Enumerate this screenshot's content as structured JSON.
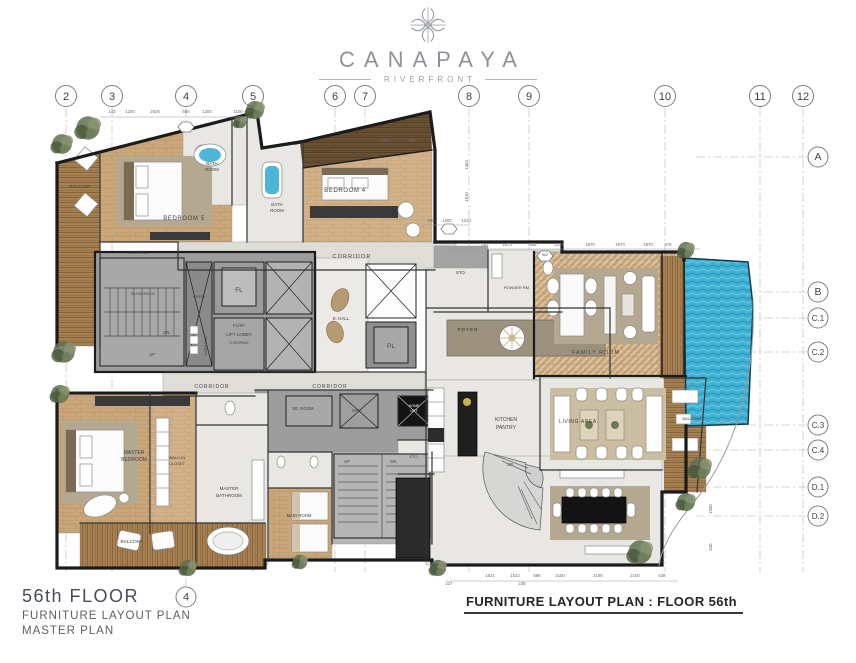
{
  "header": {
    "brand": "CANAPAYA",
    "sub": "RIVERFRONT",
    "logo_icon": "compass-rosette-icon"
  },
  "titles": {
    "floor": "56th FLOOR",
    "line1": "FURNITURE LAYOUT PLAN",
    "line2": "MASTER PLAN",
    "sheet_title": "FURNITURE LAYOUT PLAN : FLOOR 56th"
  },
  "grid": {
    "cols": [
      {
        "label": "2",
        "x": 66
      },
      {
        "label": "3",
        "x": 112
      },
      {
        "label": "4",
        "x": 186
      },
      {
        "label": "5",
        "x": 253
      },
      {
        "label": "6",
        "x": 335
      },
      {
        "label": "7",
        "x": 365
      },
      {
        "label": "8",
        "x": 469
      },
      {
        "label": "9",
        "x": 529
      },
      {
        "label": "10",
        "x": 665
      },
      {
        "label": "11",
        "x": 760
      },
      {
        "label": "12",
        "x": 803
      }
    ],
    "rows": [
      {
        "label": "A",
        "y": 157
      },
      {
        "label": "B",
        "y": 292
      },
      {
        "label": "C.1",
        "y": 318
      },
      {
        "label": "C.2",
        "y": 352
      },
      {
        "label": "C.3",
        "y": 425
      },
      {
        "label": "C.4",
        "y": 450
      },
      {
        "label": "D.1",
        "y": 487
      },
      {
        "label": "D.2",
        "y": 516
      }
    ],
    "extra": [
      {
        "label": "4",
        "x": 186,
        "y": 597
      }
    ]
  },
  "dimensions": [
    {
      "t": "143",
      "x": 112,
      "y": 113
    },
    {
      "t": "1200",
      "x": 130,
      "y": 113
    },
    {
      "t": "2625",
      "x": 155,
      "y": 113
    },
    {
      "t": "565",
      "x": 186,
      "y": 113
    },
    {
      "t": "1200",
      "x": 207,
      "y": 113
    },
    {
      "t": "2100",
      "x": 238,
      "y": 113
    },
    {
      "t": "470",
      "x": 256,
      "y": 113
    },
    {
      "t": "1083",
      "x": 386,
      "y": 142
    },
    {
      "t": "950",
      "x": 412,
      "y": 142
    },
    {
      "t": "590",
      "x": 431,
      "y": 222
    },
    {
      "t": "1300",
      "x": 447,
      "y": 222
    },
    {
      "t": "1310",
      "x": 466,
      "y": 222
    },
    {
      "t": "700",
      "x": 484,
      "y": 246
    },
    {
      "t": "1873",
      "x": 507,
      "y": 246
    },
    {
      "t": "555",
      "x": 533,
      "y": 246
    },
    {
      "t": "2235",
      "x": 559,
      "y": 246
    },
    {
      "t": "1870",
      "x": 590,
      "y": 246
    },
    {
      "t": "1870",
      "x": 620,
      "y": 246
    },
    {
      "t": "1870",
      "x": 648,
      "y": 246
    },
    {
      "t": "378",
      "x": 668,
      "y": 246
    },
    {
      "t": "1403",
      "x": 468,
      "y": 165,
      "r": -90
    },
    {
      "t": "1510",
      "x": 468,
      "y": 197,
      "r": -90
    },
    {
      "t": "1500",
      "x": 712,
      "y": 509,
      "r": -90
    },
    {
      "t": "640",
      "x": 712,
      "y": 547,
      "r": -90
    },
    {
      "t": "1521",
      "x": 490,
      "y": 577
    },
    {
      "t": "1522",
      "x": 515,
      "y": 577
    },
    {
      "t": "698",
      "x": 537,
      "y": 577
    },
    {
      "t": "2100",
      "x": 560,
      "y": 577
    },
    {
      "t": "2190",
      "x": 598,
      "y": 577
    },
    {
      "t": "2100",
      "x": 635,
      "y": 577
    },
    {
      "t": "638",
      "x": 662,
      "y": 577
    },
    {
      "t": "227",
      "x": 449,
      "y": 585
    },
    {
      "t": "238",
      "x": 522,
      "y": 585
    }
  ],
  "labels": [
    {
      "t": "BALCONY",
      "x": 80,
      "y": 188,
      "s": 4.6
    },
    {
      "t": "BEDROOM 5",
      "x": 184,
      "y": 220,
      "s": 6,
      "sp": 0.6
    },
    {
      "t": "BATH",
      "x": 212,
      "y": 165,
      "s": 4.4
    },
    {
      "t": "ROOM",
      "x": 212,
      "y": 171,
      "s": 4.4
    },
    {
      "t": "BATH",
      "x": 277,
      "y": 206,
      "s": 4.4
    },
    {
      "t": "ROOM",
      "x": 277,
      "y": 212,
      "s": 4.4
    },
    {
      "t": "BALCONY",
      "x": 322,
      "y": 153,
      "s": 4.4
    },
    {
      "t": "BEDROOM 4",
      "x": 345,
      "y": 192,
      "s": 6,
      "sp": 0.6
    },
    {
      "t": "CORRIDOR",
      "x": 352,
      "y": 258,
      "s": 5.4,
      "sp": 1.2
    },
    {
      "t": "CORRIDOR",
      "x": 212,
      "y": 388,
      "s": 5,
      "sp": 1
    },
    {
      "t": "CORRIDOR",
      "x": 330,
      "y": 388,
      "s": 5,
      "sp": 1
    },
    {
      "t": "TL/GR/F-/D-",
      "x": 137,
      "y": 254,
      "s": 3.8
    },
    {
      "t": "RL/SM/PA/CE",
      "x": 143,
      "y": 295,
      "s": 3.8
    },
    {
      "t": "DN.",
      "x": 167,
      "y": 334,
      "s": 4.4
    },
    {
      "t": "UP",
      "x": 152,
      "y": 356,
      "s": 4.4
    },
    {
      "t": "OPEN",
      "x": 199,
      "y": 298,
      "s": 4
    },
    {
      "t": "GARBAGE",
      "x": 207,
      "y": 346,
      "s": 4,
      "r": -90
    },
    {
      "t": "FL",
      "x": 239,
      "y": 292,
      "s": 6.5
    },
    {
      "t": "FL/SF",
      "x": 239,
      "y": 327,
      "s": 4.5
    },
    {
      "t": "LIFT LOBBY",
      "x": 239,
      "y": 336,
      "s": 4.5
    },
    {
      "t": "TL/GR/PA/CL",
      "x": 239,
      "y": 344,
      "s": 3.4
    },
    {
      "t": "E. HALL",
      "x": 341,
      "y": 320,
      "s": 4.4
    },
    {
      "t": "PL",
      "x": 391,
      "y": 348,
      "s": 6.5
    },
    {
      "t": "STO.",
      "x": 461,
      "y": 274,
      "s": 4.4
    },
    {
      "t": "POWDER RM.",
      "x": 517,
      "y": 289,
      "s": 4
    },
    {
      "t": "FOYER",
      "x": 468,
      "y": 331,
      "s": 4.6,
      "sp": 1,
      "c": "#2e2a24"
    },
    {
      "t": "FAMILY ROOM",
      "x": 596,
      "y": 354,
      "s": 5.4,
      "sp": 1
    },
    {
      "t": "KITCHEN",
      "x": 506,
      "y": 421,
      "s": 5
    },
    {
      "t": "PANTRY",
      "x": 506,
      "y": 429,
      "s": 5
    },
    {
      "t": "LIVING AREA",
      "x": 578,
      "y": 423,
      "s": 5,
      "sp": 0.6
    },
    {
      "t": "BALCONY",
      "x": 692,
      "y": 420,
      "s": 4
    },
    {
      "t": "UP",
      "x": 510,
      "y": 466,
      "s": 4.2
    },
    {
      "t": "MASTER",
      "x": 134,
      "y": 454,
      "s": 5
    },
    {
      "t": "BEDROOM",
      "x": 134,
      "y": 461,
      "s": 5
    },
    {
      "t": "WALK-IN",
      "x": 177,
      "y": 459,
      "s": 4
    },
    {
      "t": "CLOSET",
      "x": 177,
      "y": 465,
      "s": 4
    },
    {
      "t": "MASTER",
      "x": 229,
      "y": 490,
      "s": 4.5
    },
    {
      "t": "BATHROOM",
      "x": 229,
      "y": 497,
      "s": 4.5
    },
    {
      "t": "BALCONY",
      "x": 132,
      "y": 543,
      "s": 4.8
    },
    {
      "t": "MAID ROOM",
      "x": 299,
      "y": 517,
      "s": 4.2
    },
    {
      "t": "EE. ROOM",
      "x": 303,
      "y": 410,
      "s": 4.2
    },
    {
      "t": "SAN.",
      "x": 357,
      "y": 412,
      "s": 4.2
    },
    {
      "t": "UP",
      "x": 347,
      "y": 463,
      "s": 4.2
    },
    {
      "t": "DN.",
      "x": 394,
      "y": 463,
      "s": 4.2
    },
    {
      "t": "STO.",
      "x": 414,
      "y": 458,
      "s": 4
    },
    {
      "t": "HOME",
      "x": 414,
      "y": 407,
      "s": 3.6,
      "c": "#ffffff"
    },
    {
      "t": "LIFT",
      "x": 414,
      "y": 412,
      "s": 3.6,
      "c": "#ffffff"
    },
    {
      "t": "W2",
      "x": 545,
      "y": 256,
      "s": 4
    }
  ],
  "colors": {
    "wood": "#c9a77a",
    "wood_light": "#d4b58c",
    "deck": "#a78052",
    "deck_dark": "#6b5134",
    "marble": "#e9e7e3",
    "corridor": "#dfddd8",
    "core": "#9d9d9d",
    "shaft": "#b5b5b5",
    "wall": "#1b1b1b",
    "pool": "#3fb0d2",
    "pool_wave": "#2391b6",
    "rug": "#b5a890",
    "foyer_rug": "#9b917c",
    "tree": "#5f7050",
    "label": "#44413c",
    "dim": "#6b6b6b"
  }
}
